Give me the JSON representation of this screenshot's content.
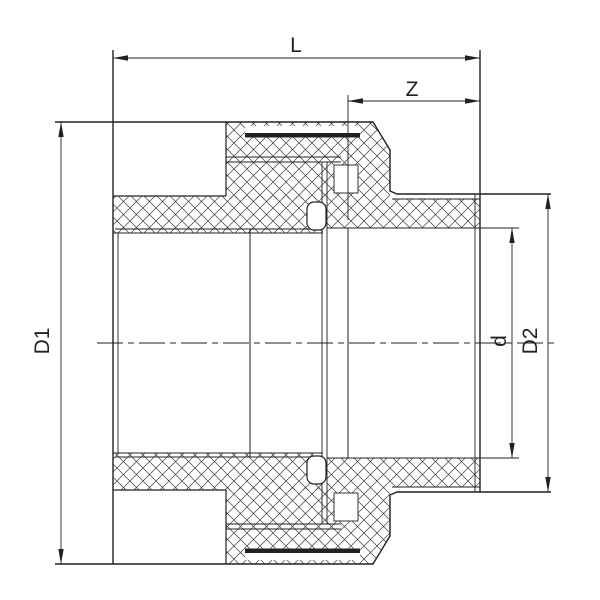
{
  "drawing": {
    "type": "engineering-section-drawing",
    "subject": "pipe union fitting cross-section",
    "background_color": "#ffffff",
    "line_color": "#212121",
    "hatch_color": "#3c3c3c",
    "labels": {
      "overall_length": "L",
      "socket_offset": "Z",
      "left_outer_diameter": "D1",
      "bore_diameter": "d",
      "right_outer_diameter": "D2"
    }
  }
}
